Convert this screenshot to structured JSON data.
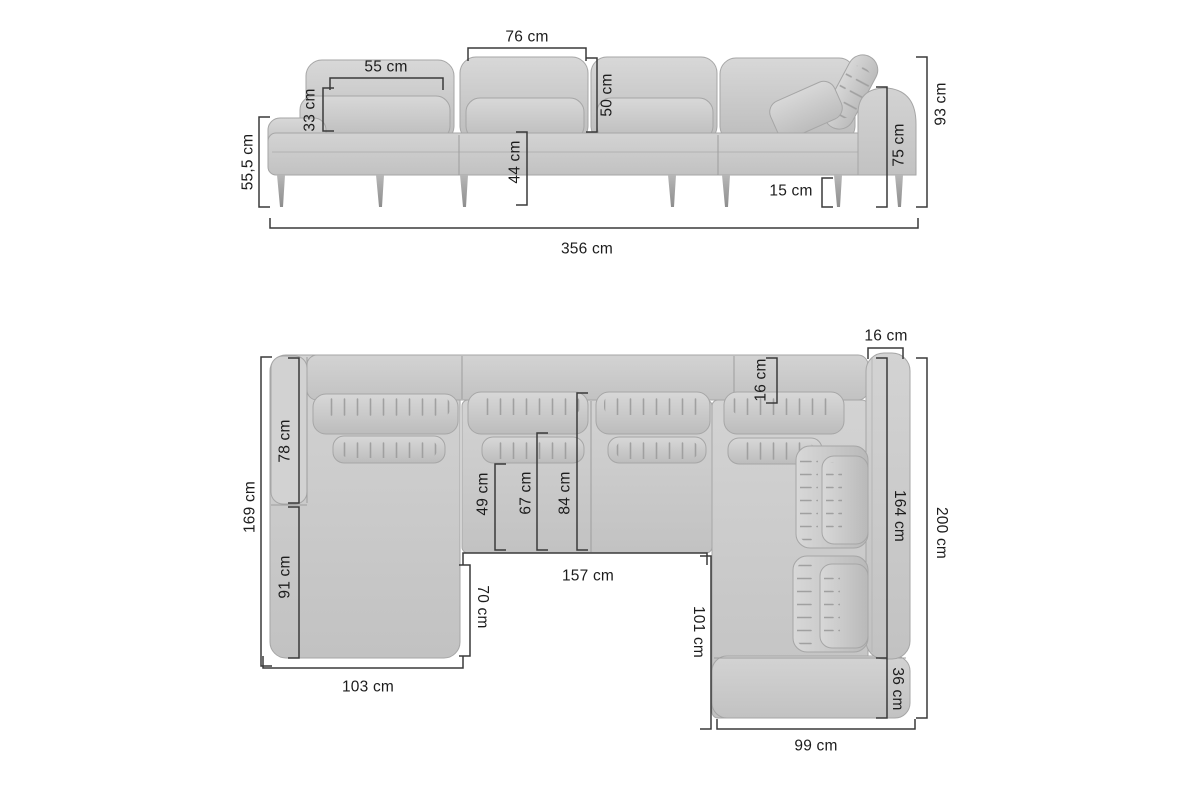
{
  "units": "cm",
  "colors": {
    "background": "#ffffff",
    "dimension_line": "#3a3a3a",
    "label_text": "#1c1c1c",
    "sofa_base": "#c9c9c9",
    "sofa_light": "#d6d6d6",
    "sofa_shadow": "#a8a8a8",
    "leg": "#9a9a9a"
  },
  "labels": {
    "front": {
      "cushion_width": "76 cm",
      "pillow_width": "55 cm",
      "pillow_height": "33 cm",
      "backrest_height": "50 cm",
      "seat_height": "44 cm",
      "side_height": "55,5 cm",
      "armrest_height": "75 cm",
      "total_height": "93 cm",
      "leg_height": "15 cm",
      "total_width": "356 cm"
    },
    "plan": {
      "armrest_width": "16 cm",
      "backrest_depth": "16 cm",
      "left_back_length": "78 cm",
      "left_side_total": "169 cm",
      "chaise_length": "91 cm",
      "seat_depth_front": "49 cm",
      "seat_depth_mid": "67 cm",
      "seat_depth_full": "84 cm",
      "middle_width": "157 cm",
      "chaise_inner_depth": "70 cm",
      "right_inner_length": "101 cm",
      "right_arm_length": "164 cm",
      "right_side_total": "200 cm",
      "end_section": "36 cm",
      "right_bottom_width": "99 cm",
      "chaise_width": "103 cm"
    }
  }
}
